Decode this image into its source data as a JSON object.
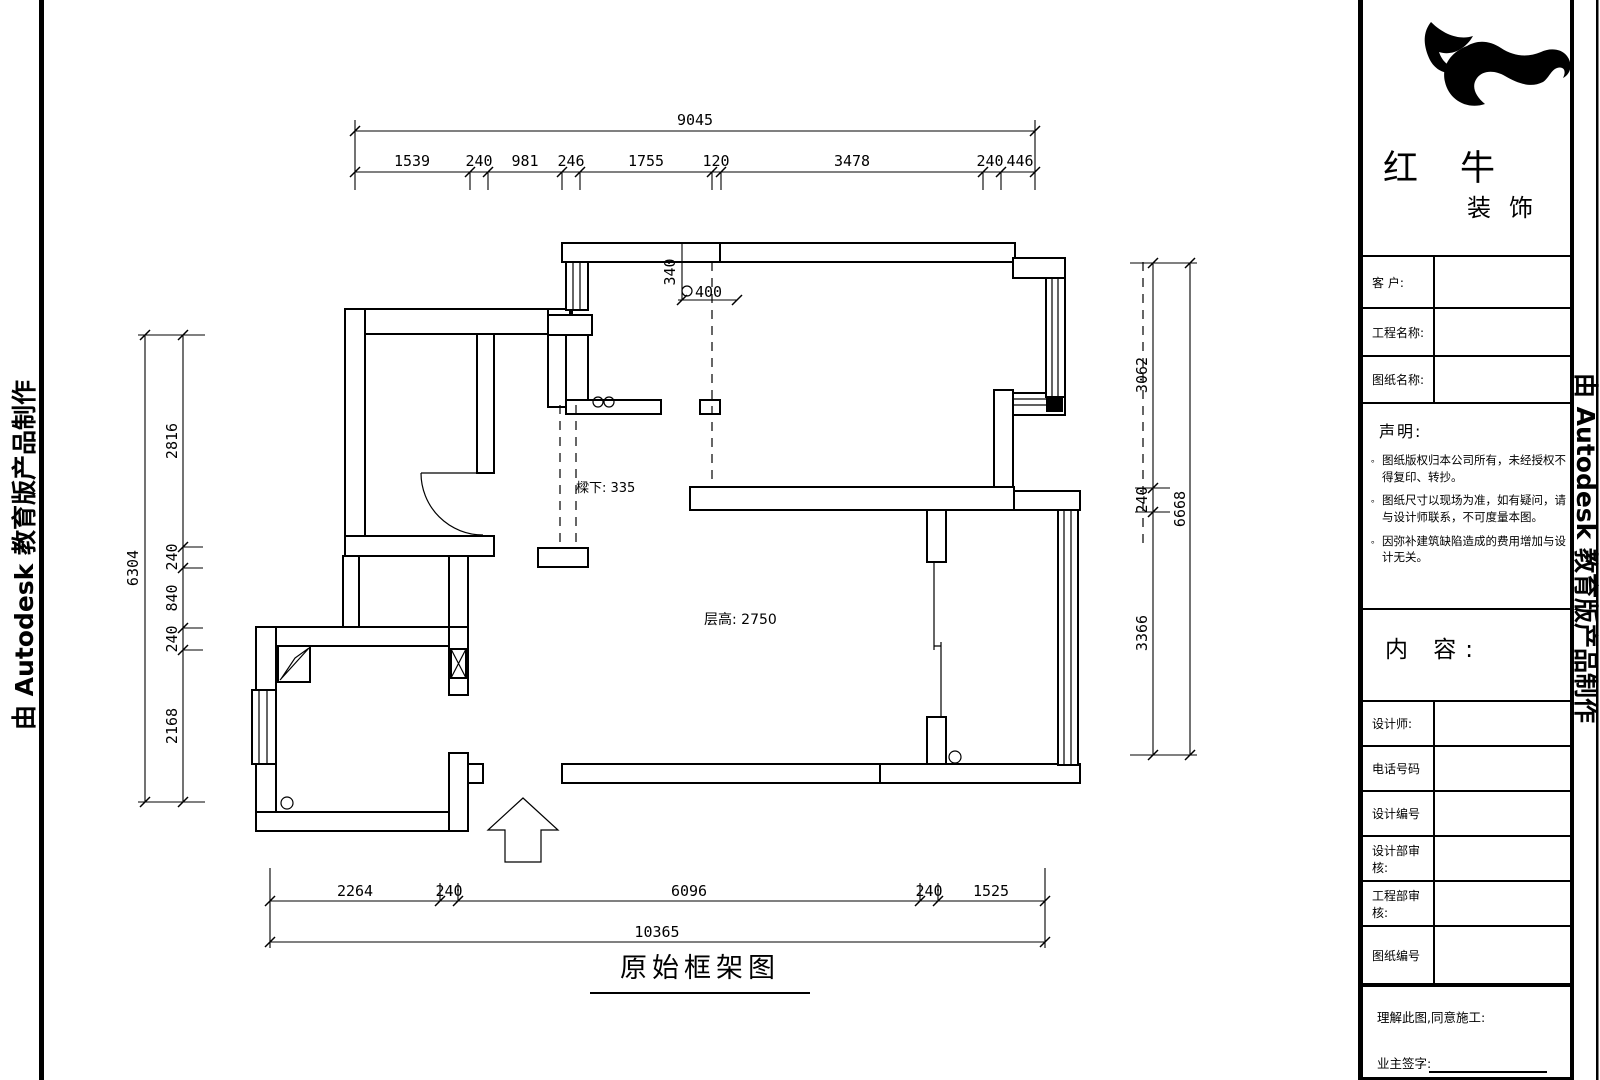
{
  "page": {
    "left_edge_text": "由 Autodesk 教育版产品制作",
    "right_edge_text": "由 Autodesk 教育版产品制作",
    "drawing_title": "原始框架图"
  },
  "dimensions": {
    "top": {
      "total": "9045",
      "segments": [
        "1539",
        "240",
        "981",
        "246",
        "1755",
        "120",
        "3478",
        "240",
        "446"
      ]
    },
    "left": {
      "total": "6304",
      "segments": [
        "2816",
        "240",
        "840",
        "240",
        "2168"
      ]
    },
    "right": {
      "total": "6668",
      "segments": [
        "3062",
        "240",
        "3366"
      ]
    },
    "bottom": {
      "total": "10365",
      "segments": [
        "2264",
        "240",
        "6096",
        "240",
        "1525"
      ]
    }
  },
  "plan": {
    "beam_label": "樑下: 335",
    "ceiling_label": "层高: 2750",
    "niche_depth": "340",
    "niche_width": "400"
  },
  "title_block": {
    "company_name": "红牛",
    "company_suffix": "装饰",
    "fields_top": [
      {
        "label": "客 户:"
      },
      {
        "label": "工程名称:"
      },
      {
        "label": "图纸名称:"
      }
    ],
    "statement": {
      "heading": "声明:",
      "bullet": "。",
      "items": [
        "图纸版权归本公司所有，未经授权不得复印、转抄。",
        "图纸尺寸以现场为准，如有疑问，请与设计师联系，不可度量本图。",
        "因弥补建筑缺陷造成的费用增加与设计无关。"
      ]
    },
    "content_heading": "内 容:",
    "fields_bottom": [
      {
        "label": "设计师:"
      },
      {
        "label": "电话号码"
      },
      {
        "label": "设计编号"
      },
      {
        "label": "设计部审核:"
      },
      {
        "label": "工程部审核:"
      },
      {
        "label": "图纸编号"
      }
    ],
    "footer": {
      "agreement": "理解此图,同意施工:",
      "owner_sign": "业主签字:"
    }
  }
}
